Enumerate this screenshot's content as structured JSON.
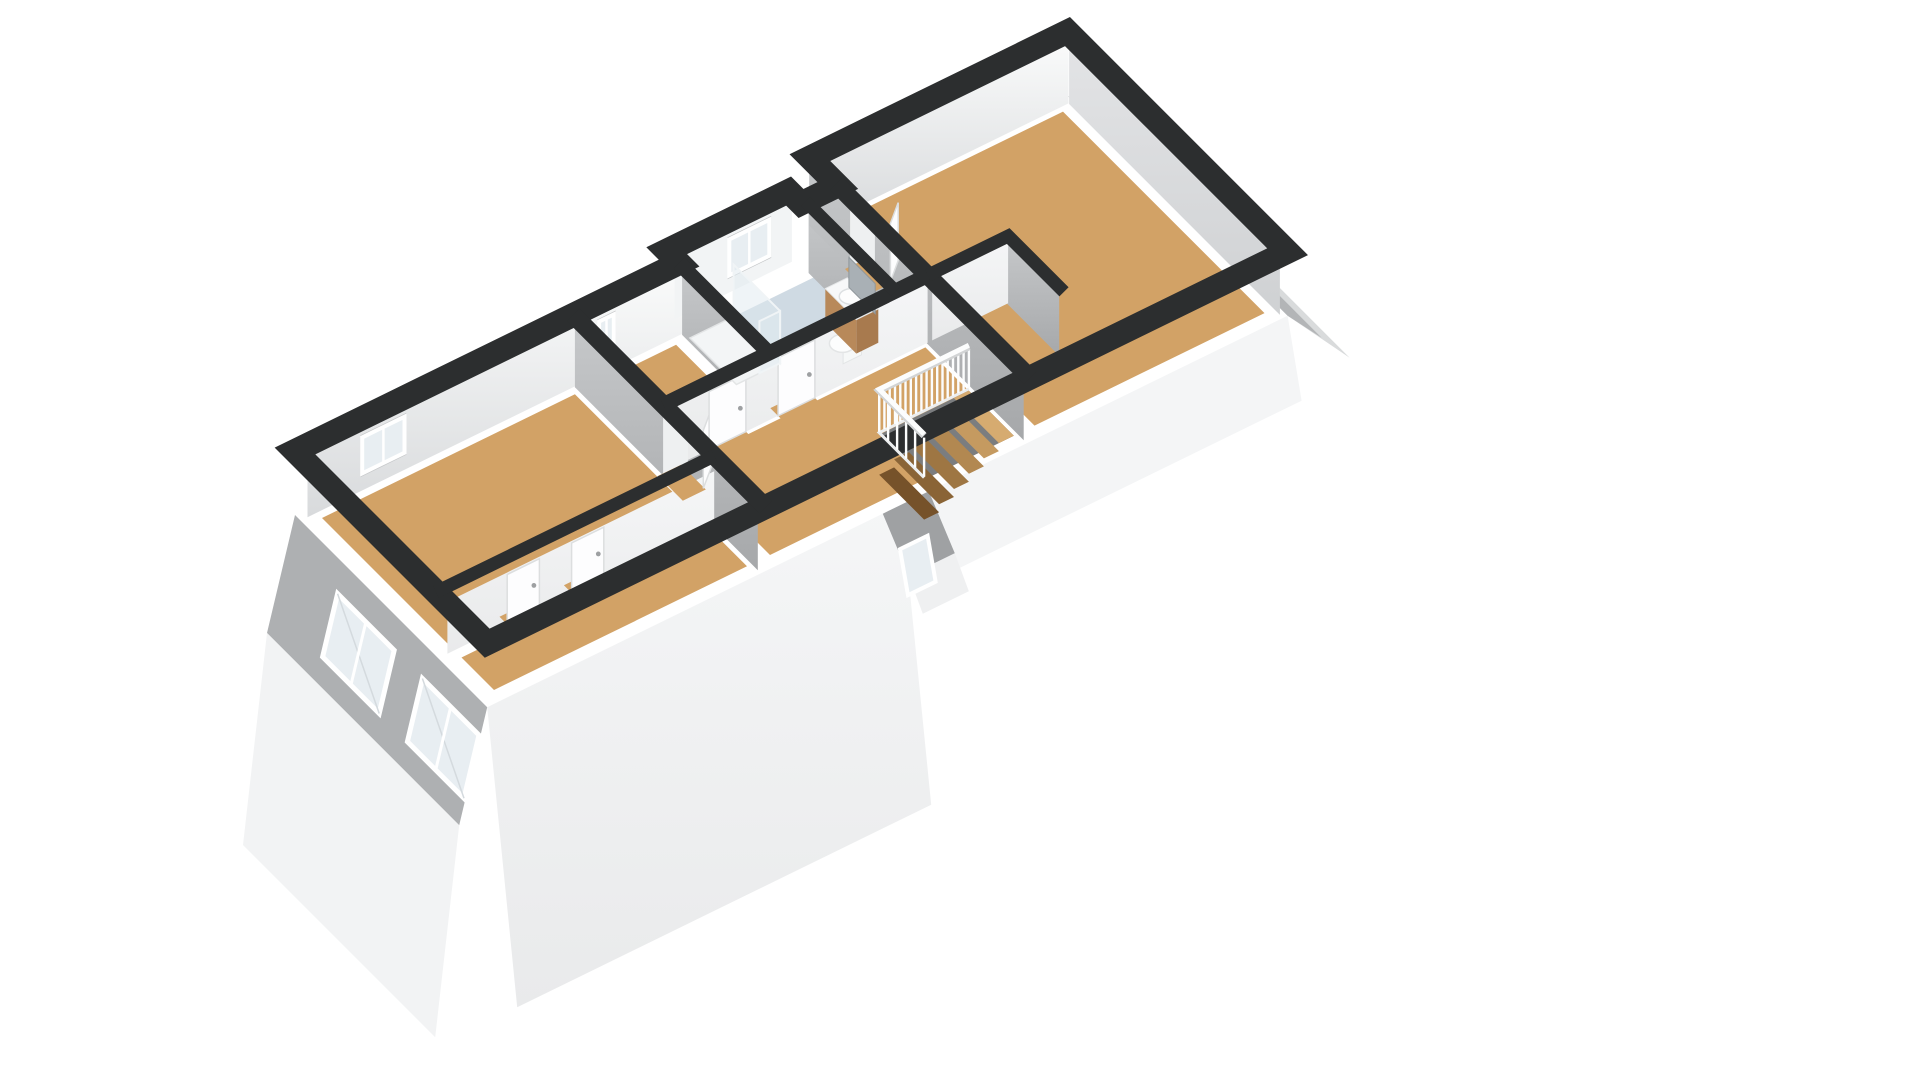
{
  "meta": {
    "view": "axonometric-3d-floorplan-render",
    "background": "#ffffff",
    "visible_text": []
  },
  "scene": {
    "palette": {
      "wallCut": "#2c2e2f",
      "wallWhiteTop": "#fafbfb",
      "wallWhiteBot": "#d8dadc",
      "wallGrayTop": "#c6c8ca",
      "wallGrayBot": "#a6a8aa",
      "exteriorGray": "#aeb0b2",
      "exteriorWhite": "#f2f3f4",
      "exteriorLow": "#f4f5f6",
      "neEndDark": "#b3b5b7",
      "neEndLight": "#d9dbdc",
      "floorWood": "#d2a266",
      "floorBath": "#cfdae3",
      "stairVoid": "#7b7d7f",
      "glass": "#e8eef2",
      "showerGlass": "#dfe9ef",
      "doorWhite": "#fdfdfe",
      "doorEdge": "#dcdedf",
      "openingLight": "#eef0f1",
      "thresholdWood": "#d2a266",
      "vanityWood": "#b8895a",
      "vanityWoodDark": "#a87a4e",
      "counterWhite": "#f7f8f9",
      "mirror": "#a9b0b5",
      "railWhite": "#fcfdfd",
      "railShadow": "#d2d4d5",
      "fixtureWhite": "#fcfdfd",
      "fixtureEdge": "#e3e5e6",
      "handle": "#9ea0a2",
      "windowFrame": "#ffffff",
      "windowReveal": "#c6c8ca",
      "roofletGray": "#9fa1a3"
    },
    "proj": {
      "origin": [
        295,
        515
      ],
      "u": [
        46,
        -22.5
      ],
      "v": [
        31,
        31
      ],
      "wallTop": -64
    },
    "floors": [
      {
        "name": "bedroom-left-floor",
        "rect": [
          0.35,
          0.35,
          5.85,
          4.4
        ],
        "color": "floorWood"
      },
      {
        "name": "knee-closet-floor",
        "rect": [
          0.35,
          4.85,
          5.85,
          5.9
        ],
        "color": "floorWood"
      },
      {
        "name": "study-floor",
        "rect": [
          6.35,
          0.35,
          8.05,
          2.75
        ],
        "color": "floorWood"
      },
      {
        "name": "bathroom-floor",
        "rect": [
          8.35,
          0.35,
          11.05,
          2.75
        ],
        "color": "floorBath"
      },
      {
        "name": "hallway-floor",
        "rect": [
          6.35,
          3.05,
          11.65,
          5.9
        ],
        "color": "floorWood"
      },
      {
        "name": "closet-nook-floor",
        "rect": [
          11.3,
          0.2,
          11.65,
          2.75
        ],
        "color": "floorWood"
      },
      {
        "name": "bedroom-right-floor",
        "rect": [
          12.1,
          -0.6,
          17.1,
          5.9
        ],
        "color": "floorWood"
      }
    ],
    "stair": {
      "opening": [
        9.7,
        4.45,
        11.65,
        5.9
      ],
      "stepColors": [
        "#d6ab70",
        "#c59a60",
        "#b28851",
        "#9e7643",
        "#8a6436",
        "#76522a"
      ],
      "railBalusters": 18,
      "returnBalusters": 6
    },
    "bands": [
      {
        "name": "perimeter-walls",
        "w": 24,
        "close": true,
        "pts": [
          [
            0,
            0
          ],
          [
            8.35,
            0
          ],
          [
            8.35,
            -0.4
          ],
          [
            11.0,
            -0.4
          ],
          [
            11.0,
            0
          ],
          [
            11.8,
            0
          ],
          [
            11.8,
            -0.9
          ],
          [
            17.4,
            -0.9
          ],
          [
            17.4,
            6.2
          ],
          [
            0,
            6.2
          ]
        ]
      },
      {
        "name": "partition-left-wall",
        "w": 18,
        "pts": [
          [
            6.05,
            0
          ],
          [
            6.05,
            6.2
          ]
        ]
      },
      {
        "name": "partition-study-bath",
        "w": 15,
        "pts": [
          [
            8.35,
            0
          ],
          [
            8.35,
            2.9
          ]
        ]
      },
      {
        "name": "partition-south-wall",
        "w": 15,
        "pts": [
          [
            6.05,
            2.9
          ],
          [
            11.8,
            2.9
          ]
        ]
      },
      {
        "name": "partition-right-wall",
        "w": 18,
        "pts": [
          [
            11.8,
            -0.05
          ],
          [
            11.8,
            6.2
          ]
        ]
      },
      {
        "name": "partition-vanity-wall",
        "w": 13,
        "pts": [
          [
            11.1,
            0
          ],
          [
            11.1,
            2.9
          ]
        ]
      },
      {
        "name": "closet-box-walls",
        "w": 13,
        "pts": [
          [
            11.8,
            2.9
          ],
          [
            13.55,
            2.9
          ],
          [
            13.55,
            4.7
          ]
        ]
      },
      {
        "name": "knee-wall",
        "w": 13,
        "pts": [
          [
            0,
            4.55
          ],
          [
            6.05,
            4.55
          ]
        ]
      }
    ],
    "windows": [
      {
        "name": "bedroom-left-window",
        "y": 0.18,
        "x": [
          1.3,
          2.3
        ]
      },
      {
        "name": "study-window",
        "y": 0.18,
        "x": [
          6.45,
          6.85
        ]
      },
      {
        "name": "bathroom-window",
        "y": -0.22,
        "x": [
          9.55,
          10.5
        ]
      }
    ],
    "gableWindows": [
      {
        "name": "gable-window-1",
        "quad": [
          [
            337.6,
            593.7
          ],
          [
            394.2,
            650.3
          ],
          [
            379.2,
            713.5
          ],
          [
            322.6,
            656.9
          ]
        ]
      },
      {
        "name": "gable-window-2",
        "quad": [
          [
            422.4,
            678.5
          ],
          [
            479.0,
            735.1
          ],
          [
            464.0,
            798.3
          ],
          [
            407.4,
            741.7
          ]
        ]
      }
    ],
    "doors": [
      {
        "name": "door-bedroom-left",
        "type": "openingX",
        "x": 6.05,
        "y": [
          3.0,
          3.8
        ]
      },
      {
        "name": "door-study",
        "type": "leafY",
        "y": 2.97,
        "x": [
          7.0,
          7.8
        ]
      },
      {
        "name": "door-bathroom",
        "type": "leafY",
        "y": 2.97,
        "x": [
          8.5,
          9.3
        ]
      },
      {
        "name": "door-bedroom-right",
        "type": "openingX",
        "x": 11.8,
        "y": [
          0.5,
          1.3
        ]
      },
      {
        "name": "door-knee-1",
        "type": "leafY",
        "y": 4.62,
        "x": [
          1.5,
          2.2
        ]
      },
      {
        "name": "door-knee-2",
        "type": "leafY",
        "y": 4.62,
        "x": [
          2.9,
          3.6
        ]
      }
    ],
    "fixtures": {
      "showerTray": [
        8.35,
        0.35,
        9.3,
        1.85
      ],
      "toiletCenter": [
        10.35,
        2.3
      ],
      "vanity": [
        10.55,
        1.45,
        11.03,
        2.45
      ],
      "mirrorY": [
        1.5,
        2.35
      ]
    }
  }
}
